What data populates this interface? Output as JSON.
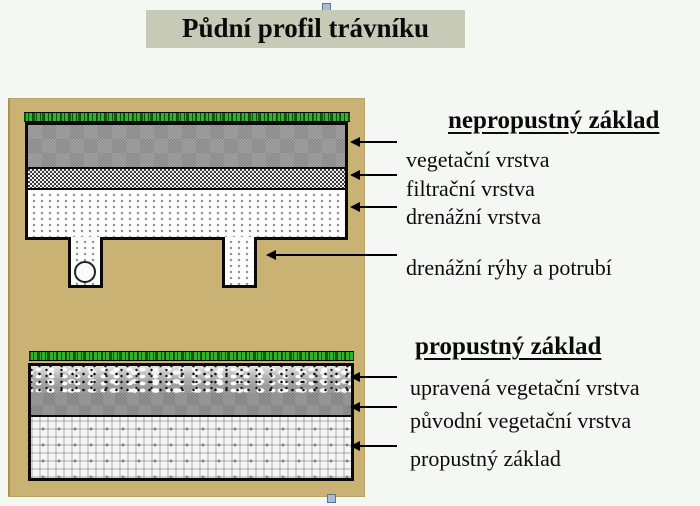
{
  "slide": {
    "title": "Půdní profil trávníku"
  },
  "diagram_top": {
    "heading": "nepropustný základ",
    "layer_labels": [
      "vegetační vrstva",
      "filtrační vrstva",
      "drenážní vrstva",
      "drenážní rýhy a potrubí"
    ]
  },
  "diagram_bottom": {
    "heading": "propustný základ",
    "layer_labels": [
      "upravená vegetační vrstva",
      "původní vegetační vrstva",
      "propustný základ"
    ]
  },
  "colors": {
    "page_bg": "#f3f9f2",
    "title_bg": "#c6cab7",
    "panel_bg": "#c9b273",
    "grass_green": "#2fb32f",
    "text": "#0b0b0b",
    "handle_fill": "#a9bcd2",
    "handle_border": "#5d7594"
  }
}
